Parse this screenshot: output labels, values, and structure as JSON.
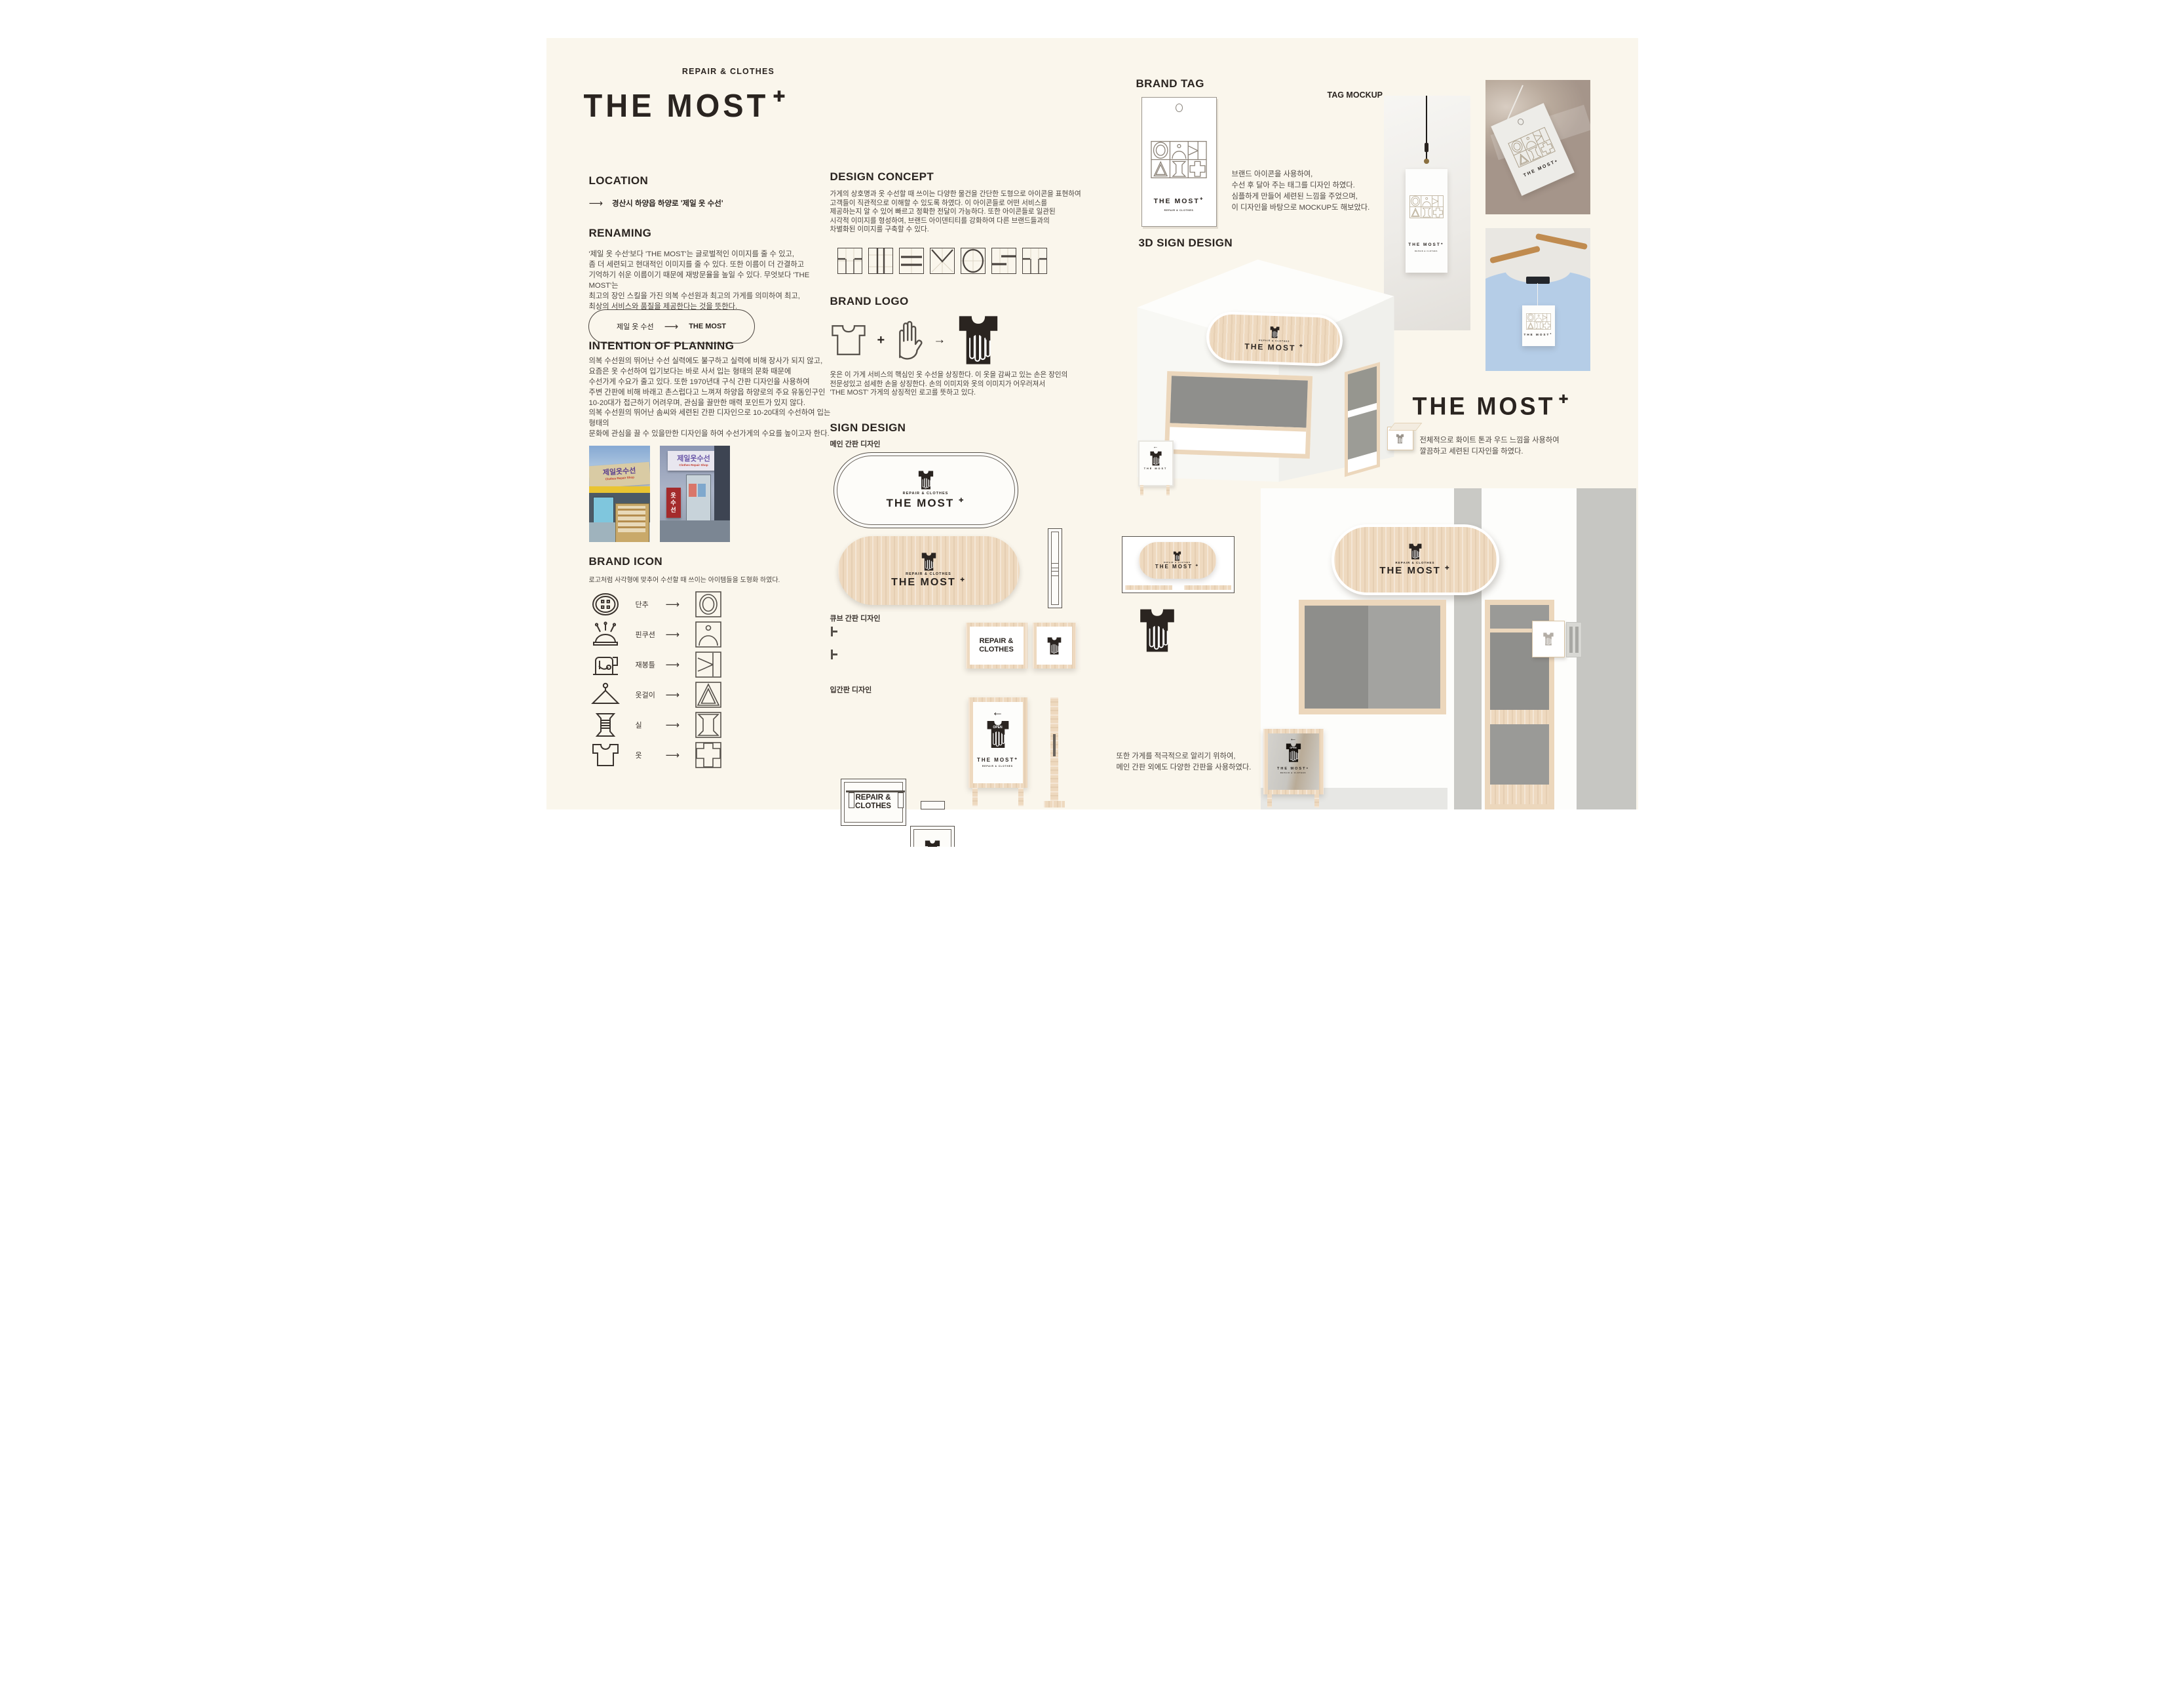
{
  "colors": {
    "board_cream": "#faf6ec",
    "ink": "#2a2420",
    "wood": "#eed9bf",
    "glass_gray": "#8f8f8c",
    "wall_gray": "#c7c7c3",
    "photo_blue": "#b5cde7"
  },
  "header": {
    "tagline": "REPAIR & CLOTHES",
    "brand": "THE MOST",
    "plus": "✚"
  },
  "icons": {
    "arrow_right": "⟶",
    "arrow_left": "←",
    "equation_plus": "+",
    "equation_arrow": "→"
  },
  "location": {
    "heading": "LOCATION",
    "text": "경산시 하양읍 하양로 '제일 옷 수선'"
  },
  "renaming": {
    "heading": "RENAMING",
    "body": "'제일 옷 수선'보다 'THE MOST'는 글로벌적인 이미지를 줄 수 있고,\n좀 더 세련되고 현대적인 이미지를 줄 수 있다. 또한 이름이 더 간결하고\n기억하기 쉬운 이름이기 때문에 재방문율을 높일 수 있다. 무엇보다 'THE MOST'는\n최고의 장인 스킬을 가진 의복 수선원과 최고의 가게를 의미하여 최고,\n최상의 서비스와 품질을 제공한다는 것을 뜻한다.",
    "pill_from": "제일 옷 수선",
    "pill_to": "THE MOST"
  },
  "intention": {
    "heading": "INTENTION OF PLANNING",
    "body1": "의복 수선원의 뛰어난 수선 실력에도 불구하고 실력에 비해 장사가 되지 않고,\n요즘은 옷 수선하여 입기보다는 바로 사서 입는 형태의 문화 때문에\n수선가게 수요가 줄고 있다. 또한 1970년대 구식 간판 디자인을 사용하여\n주변 간판에 비해 바래고 촌스럽다고 느껴져 하양읍 하양로의 주요 유동인구인\n10-20대가 접근하기 어려우며, 관심을 끌만한 매력 포인트가 있지 않다.",
    "body2": "의복 수선원의 뛰어난 솜씨와 세련된 간판 디자인으로 10-20대의 수선하여 입는 형태의\n문화에 관심을 끌 수 있을만한 디자인을 하여 수선가게의 수요를 높이고자 한다."
  },
  "photos": {
    "sign1": "제일옷수선",
    "sign1_sub": "Clothes Repair Shop",
    "sign2": "제일옷수선",
    "sign2_sub": "Clothes Repair Shop",
    "banner2": "옷수선"
  },
  "brand_icon": {
    "heading": "BRAND ICON",
    "subtitle": "로고처럼 사각형에 맞추어 수선할 때 쓰이는 아이템들을 도형화 하였다.",
    "items": [
      {
        "label": "단추"
      },
      {
        "label": "핀쿠션"
      },
      {
        "label": "재봉틀"
      },
      {
        "label": "옷걸이"
      },
      {
        "label": "실"
      },
      {
        "label": "옷"
      }
    ]
  },
  "design_concept": {
    "heading": "DESIGN CONCEPT",
    "body": "가게의 상호명과 옷 수선할 때 쓰이는 다양한 물건을 간단한 도형으로 아이콘을 표현하여\n고객들이 직관적으로 이해할 수 있도록 하였다. 이 아이콘들로 어떤 서비스를\n제공하는지 알 수 있어 빠르고 정확한 전달이 가능하다. 또한 아이콘들로 일관된\n시각적 이미지를 형성하여, 브랜드 아이덴티티를 강화하여 다른 브랜드들과의\n차별화된 이미지를 구축할 수 있다."
  },
  "brand_logo": {
    "heading": "BRAND LOGO",
    "body": "옷은 이 가게 서비스의 핵심인 옷 수선을 상징한다. 이 옷을 감싸고 있는 손은 장인의\n전문성있고 섬세한 손을 상징한다. 손의 이미지와 옷의 이미지가 어우러져서\n'THE MOST' 가게의 상징적인 로고를 뜻하고 있다."
  },
  "sign_design": {
    "heading": "SIGN DESIGN",
    "main_label": "메인 간판 디자인",
    "cube_label": "큐브 간판 디자인",
    "stand_label": "입간판 디자인",
    "small": "REPAIR & CLOTHES",
    "big": "THE MOST",
    "cube_lines": "REPAIR &\nCLOTHES",
    "open": "OPEN"
  },
  "brand_tag": {
    "heading": "BRAND TAG",
    "body": "브랜드 아이콘을 사용하여,\n수선 후 달아 주는 태그를 디자인 하였다.\n심플하게 만들어 세련된 느낌을 주었으며,\n이 디자인을 바탕으로 MOCKUP도 해보았다.",
    "mockup_label": "TAG MOCKUP"
  },
  "sign3d": {
    "heading": "3D SIGN DESIGN",
    "body": "전체적으로 화이트 톤과 우드 느낌을 사용하여\n깔끔하고 세련된 디자인을 하였다.",
    "body2": "또한 가게를 적극적으로 알리기 위하여,\n메인 간판 외에도 다양한 간판을 사용하였다."
  }
}
